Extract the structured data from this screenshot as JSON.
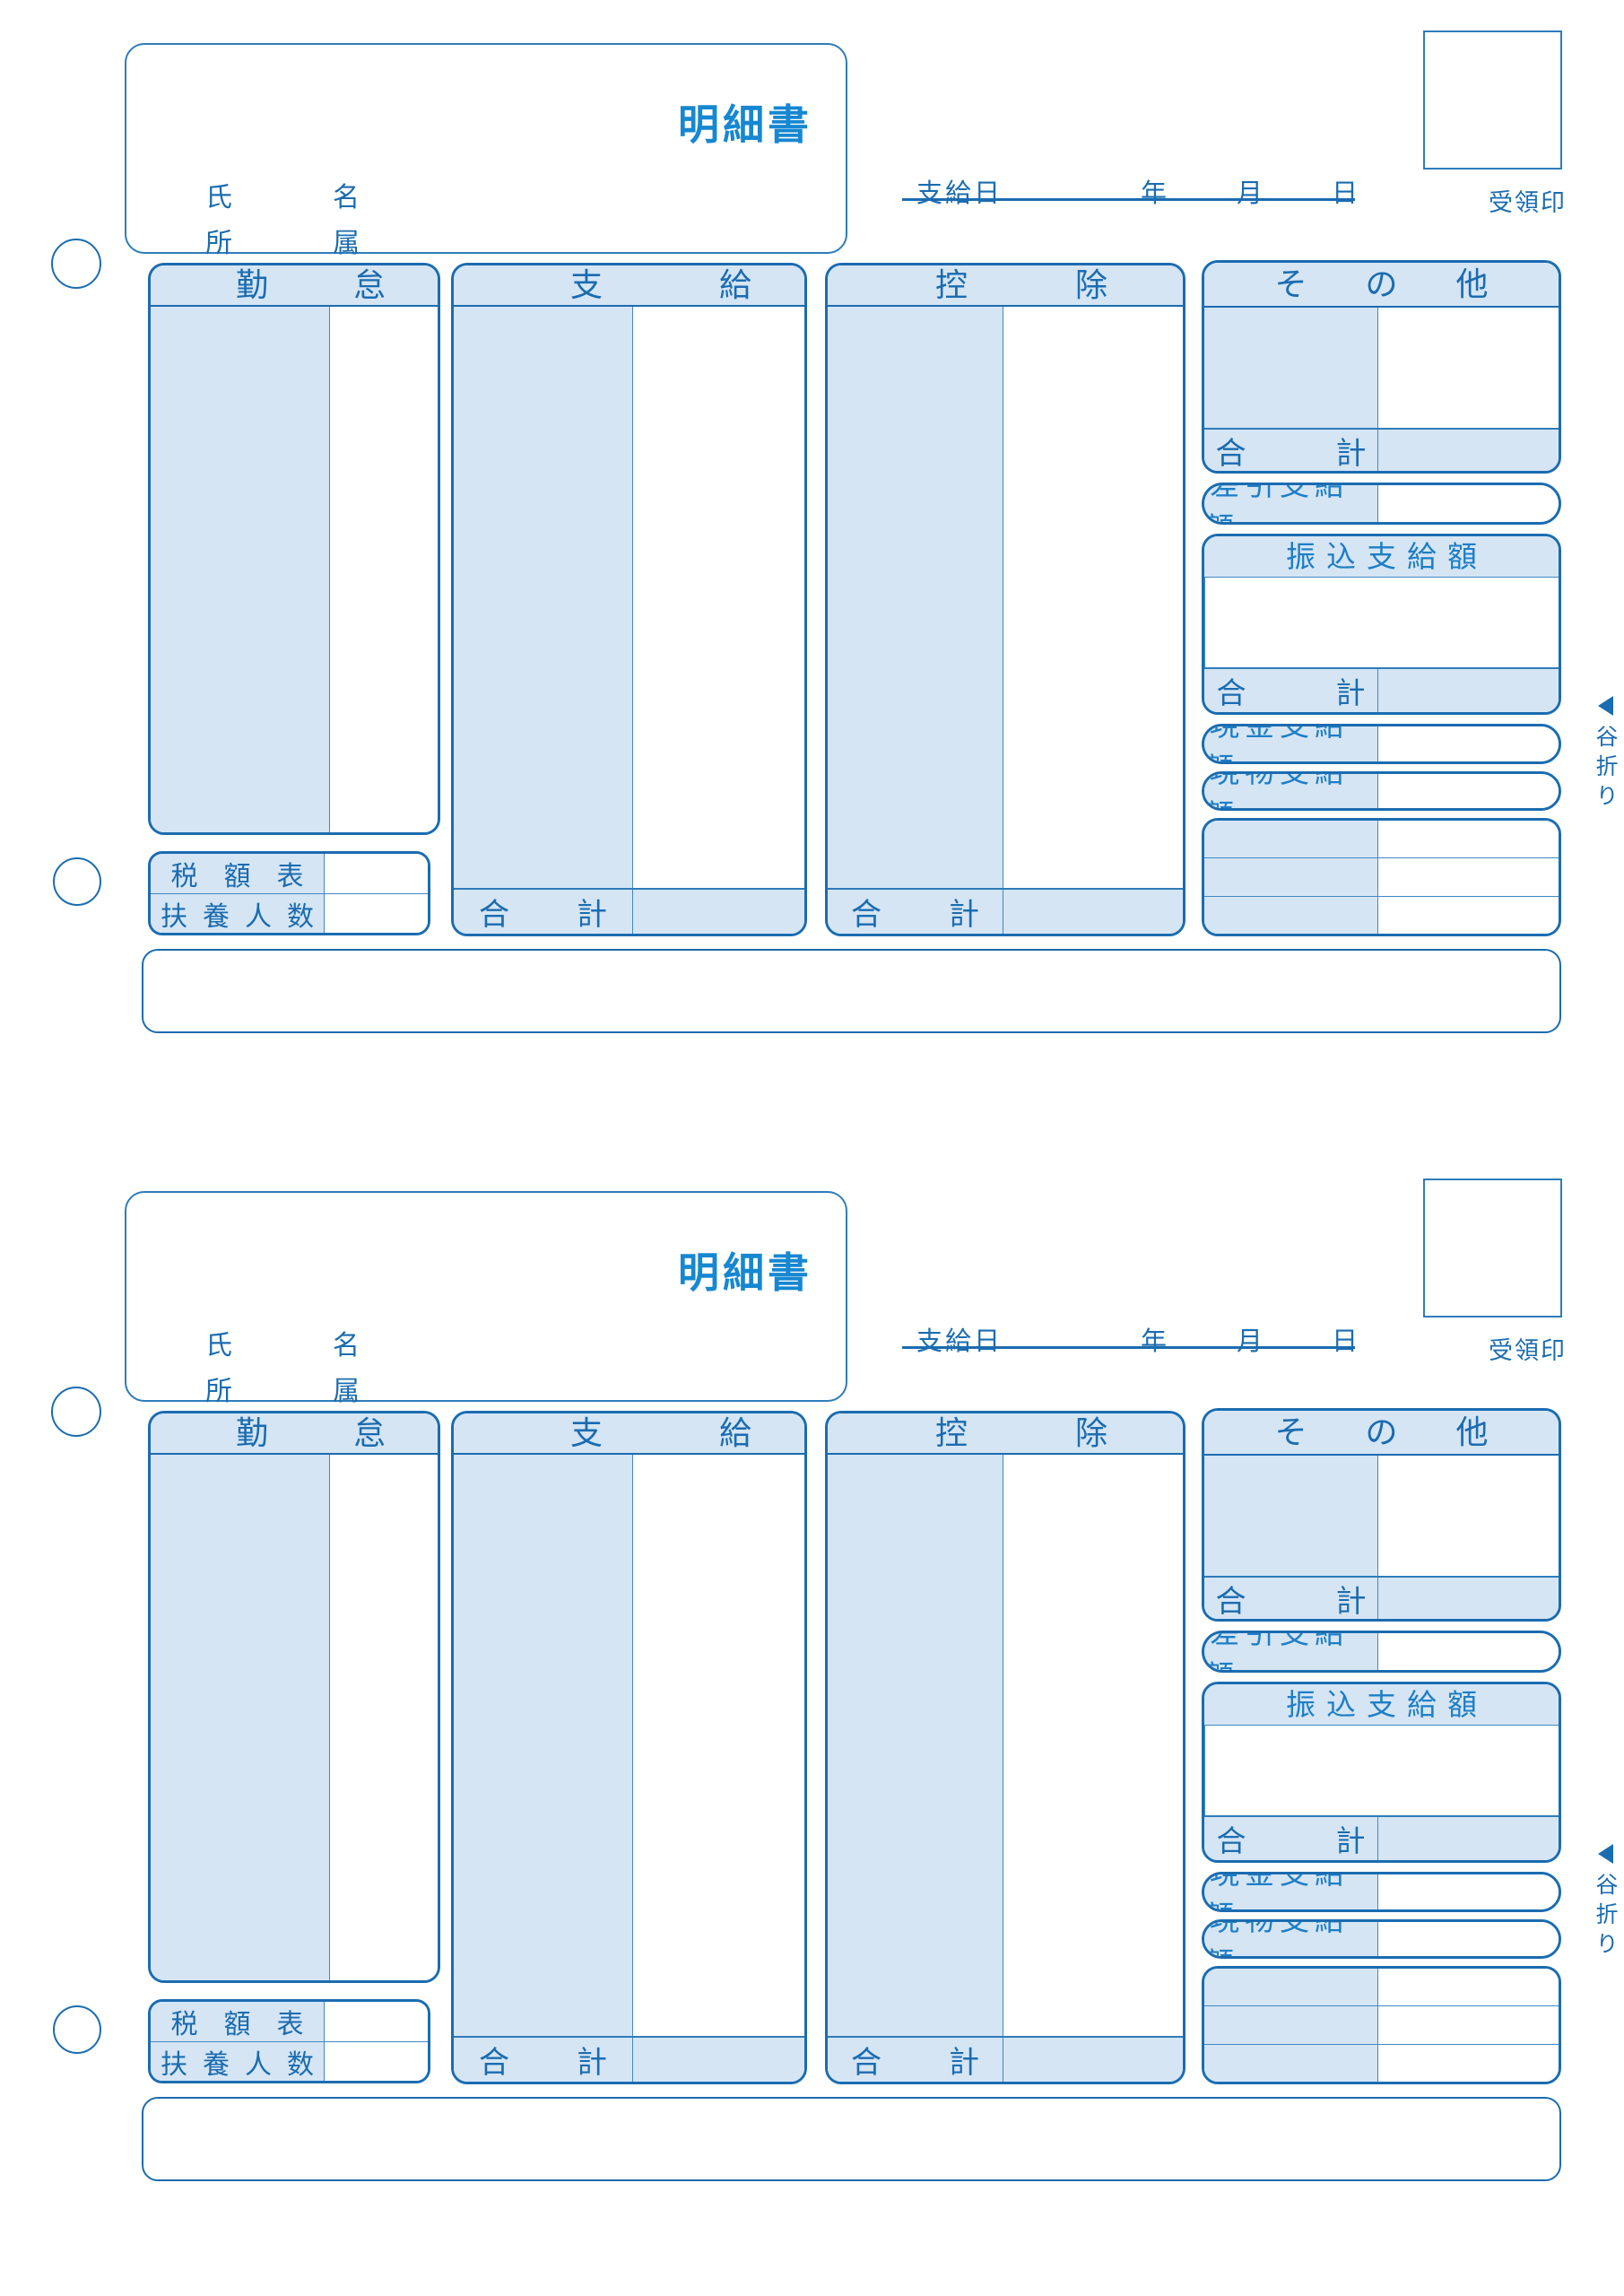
{
  "colors": {
    "border_blue": "#1b6cb0",
    "divider_blue": "#4189c4",
    "panel_fill": "#d5e5f4",
    "title_blue": "#1787d1",
    "gothic_label_blue": "#1e7ec6"
  },
  "form": {
    "title": "明細書",
    "fields": {
      "name": "氏　名",
      "department": "所　属"
    },
    "payment_date": {
      "label": "支給日",
      "year": "年",
      "month": "月",
      "day": "日"
    },
    "receipt_stamp": "受領印",
    "columns": {
      "attendance": "勤怠",
      "payment": "支給",
      "deduction": "控除",
      "other": "その他"
    },
    "total": "合計",
    "net_payment": "差引支給額",
    "transfer_payment": "振込支給額",
    "cash_payment": "現金支給額",
    "in_kind_payment": "現物支給額",
    "tax_table": "税額表",
    "dependents": "扶養人数",
    "fold_mark": "谷折り"
  }
}
